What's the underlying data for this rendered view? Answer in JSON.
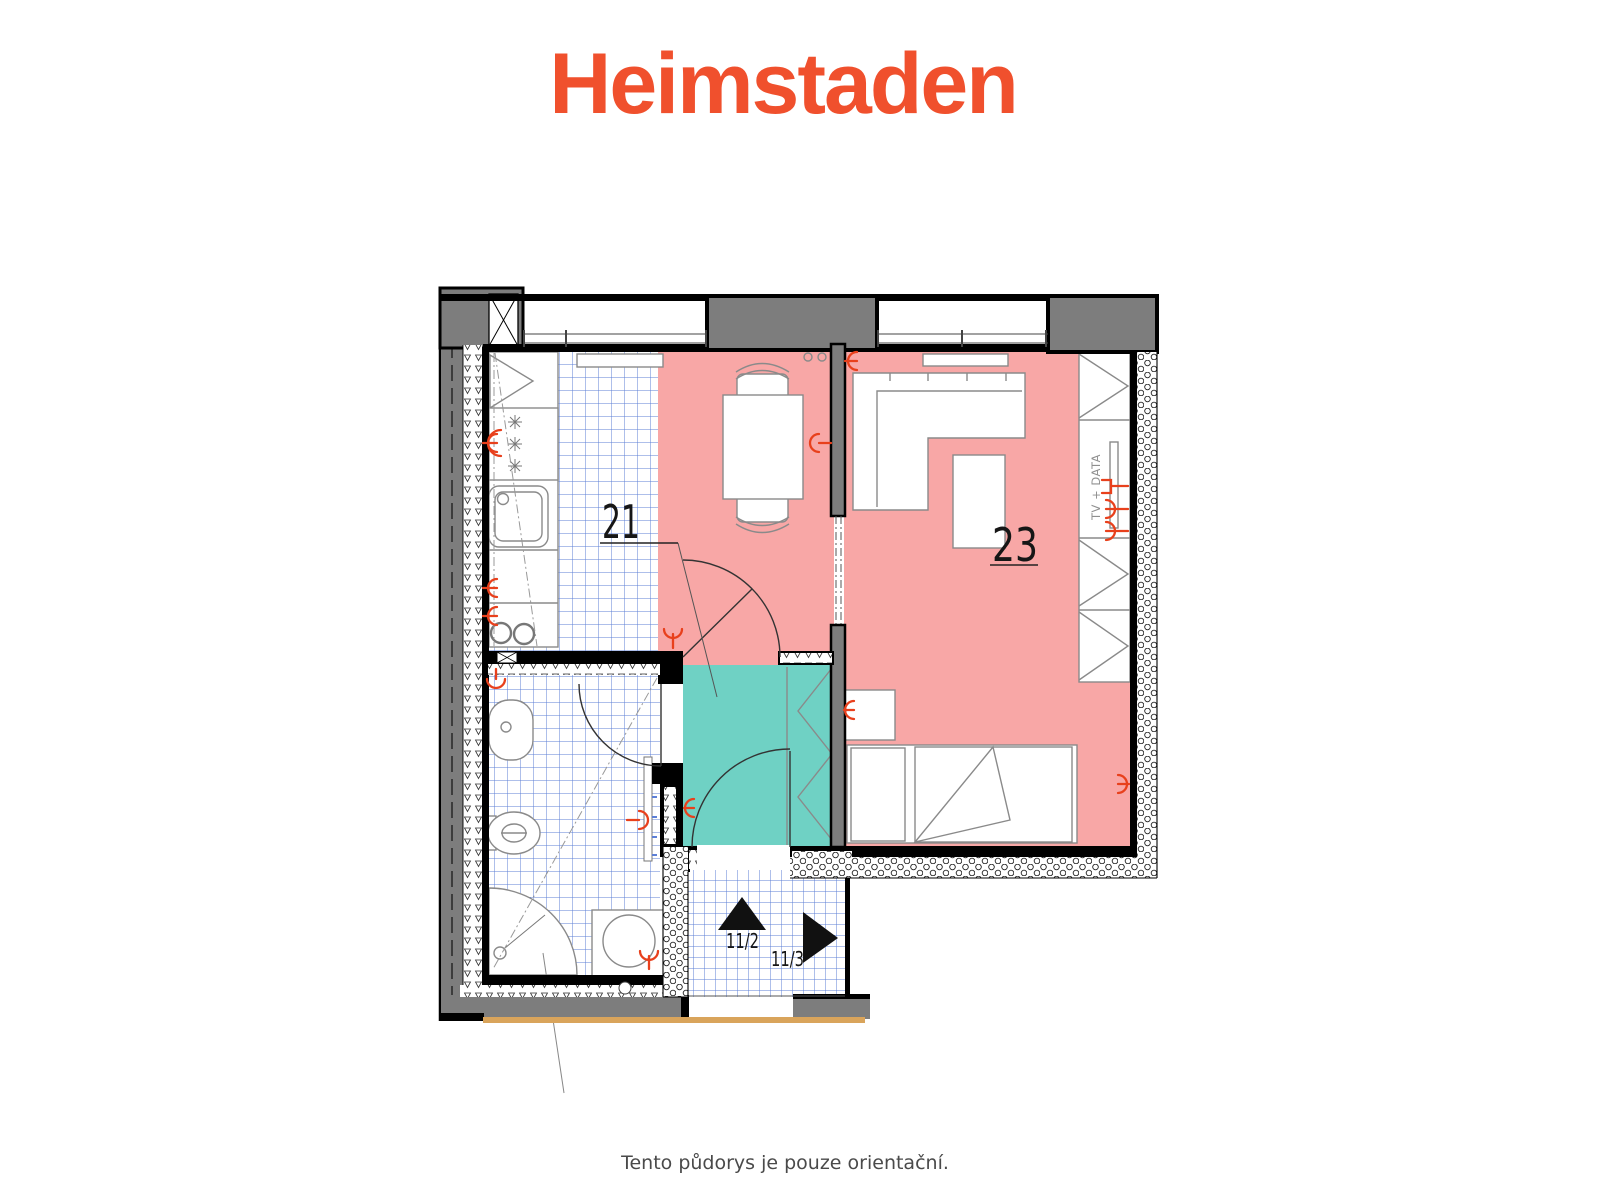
{
  "header": {
    "logo_text": "Heimstaden"
  },
  "footer": {
    "disclaimer": "Tento půdorys je pouze orientační."
  },
  "floorplan": {
    "room_labels": [
      {
        "id": "21",
        "text": "21"
      },
      {
        "id": "23",
        "text": "23"
      }
    ],
    "corridor_markers": [
      {
        "text": "11/2",
        "direction": "up"
      },
      {
        "text": "11/3",
        "direction": "right"
      }
    ],
    "tv_data_label": "TV + DATA",
    "colors": {
      "logo_orange": "#F0502D",
      "room_pink": "#F8A7A6",
      "hall_teal": "#6FD1C4",
      "wall_gray": "#7D7D7D",
      "tile_blue": "#5C7FD6",
      "symbol_red": "#E8401C",
      "floor_tan": "#D9A45B",
      "footer_gray": "#4A4A4A"
    }
  }
}
